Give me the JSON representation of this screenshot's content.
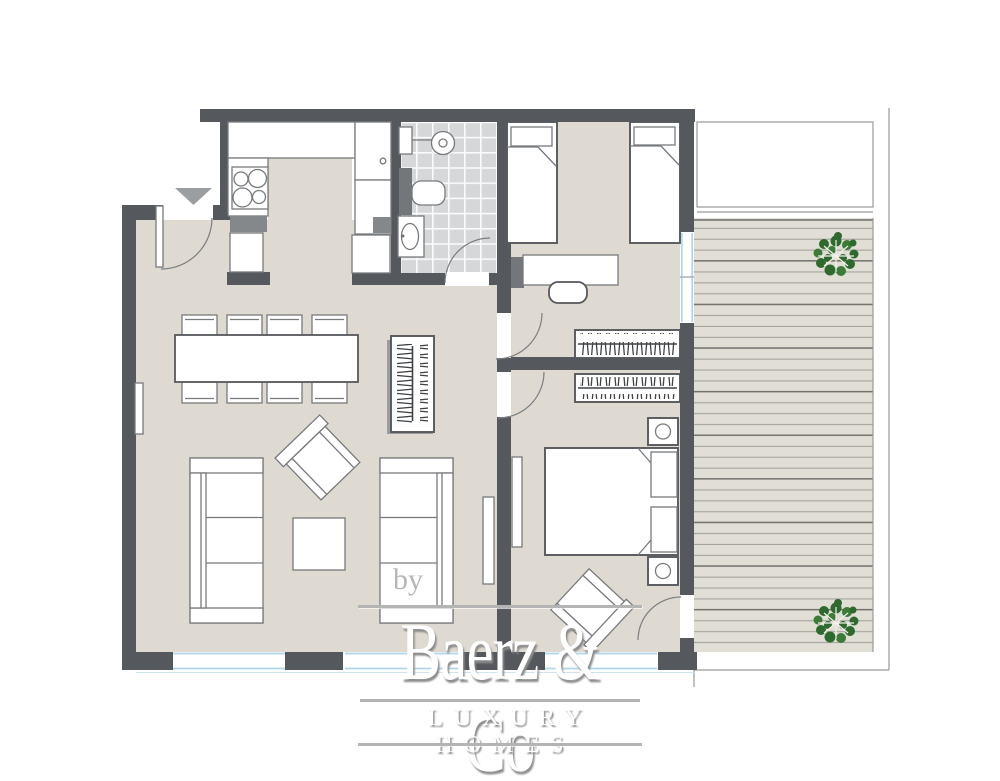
{
  "watermark": {
    "prefix": "by",
    "brand": "Baerz & Co",
    "tagline": "LUXURY HOMES"
  },
  "colors": {
    "wall": "#55585c",
    "floor": "#dedad1",
    "deck": "#e1ded5",
    "tile": "#d6d7d8",
    "appliance": "#85888b",
    "appliance-dark": "#74777a",
    "window": "#aed6e8",
    "plant": "#2e6a2e",
    "plant-alt": "#3c7c38",
    "line": "#777a7d",
    "outline": "#9a9a96",
    "arrow": "#9b9ea1",
    "watermark": "#ffffff",
    "watermark-shadow": "#8c8c8c"
  }
}
